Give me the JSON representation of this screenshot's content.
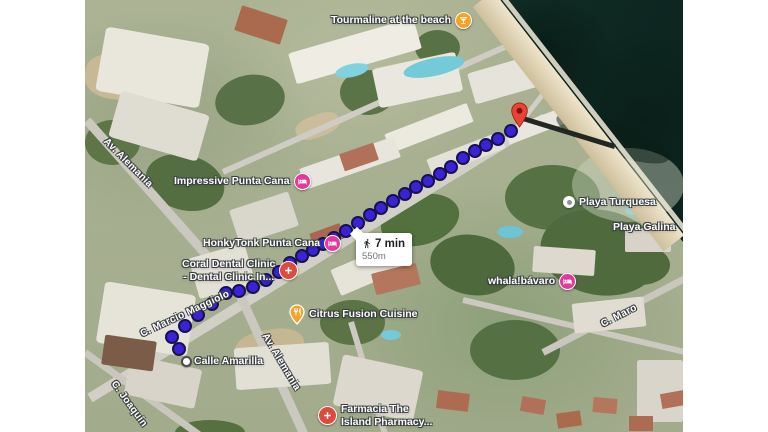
{
  "app": {
    "type": "map-satellite-view",
    "description": "Walking route on satellite map, Punta Cana"
  },
  "route_info": {
    "mode": "walking",
    "duration": "7 min",
    "distance": "550m"
  },
  "pois": {
    "tourmaline": {
      "label": "Tourmaline at the beach",
      "icon": "cocktail",
      "color": "#F4A326"
    },
    "impressive": {
      "label": "Impressive Punta Cana",
      "icon": "hotel-bed",
      "color": "#E4399B"
    },
    "honkytonk": {
      "label": "HonkyTonk Punta Cana",
      "icon": "hotel-bed",
      "color": "#E4399B"
    },
    "coral_dental": {
      "label_line1": "Coral Dental Clinic",
      "label_line2": "- Dental Clinic In...",
      "icon": "medical-cross",
      "color": "#DC4B3E"
    },
    "citrus": {
      "label": "Citrus Fusion Cuisine",
      "icon": "restaurant",
      "color": "#F4A326"
    },
    "whala": {
      "label": "whala!bávaro",
      "icon": "hotel-bed",
      "color": "#E4399B"
    },
    "playa_turquesa": {
      "label": "Playa Turquesa",
      "icon": "beach-dot"
    },
    "playa_galina": {
      "label": "Playa Galina"
    },
    "farmacia": {
      "label_line1": "Farmacia The",
      "label_line2": "Island Pharmacy...",
      "icon": "medical-cross",
      "color": "#DC4B3E"
    },
    "calle_amarilla": {
      "label": "Calle Amarilla"
    }
  },
  "streets": {
    "av_alemania_top": {
      "label": "Av. Alemania"
    },
    "av_alemania_bottom": {
      "label": "Av. Alemania"
    },
    "marcio_maggiolo": {
      "label": "C. Marcio Maggiolo"
    },
    "joaquin": {
      "label": "C. Joaquín"
    },
    "maro": {
      "label": "C. Maro"
    }
  },
  "route": {
    "start_point": [
      101,
      361
    ],
    "end_point": [
      434,
      127
    ],
    "dot_color": "#3A23D6",
    "dot_ring_color": "#191052",
    "path": [
      [
        94,
        349
      ],
      [
        87,
        337
      ],
      [
        100,
        326
      ],
      [
        113,
        315
      ],
      [
        127,
        304
      ],
      [
        141,
        293
      ],
      [
        154,
        291
      ],
      [
        168,
        287
      ],
      [
        181,
        280
      ],
      [
        194,
        272
      ],
      [
        205,
        263
      ],
      [
        217,
        256
      ],
      [
        228,
        250
      ],
      [
        238,
        244
      ],
      [
        249,
        238
      ],
      [
        261,
        231
      ],
      [
        273,
        223
      ],
      [
        285,
        215
      ],
      [
        296,
        208
      ],
      [
        308,
        201
      ],
      [
        320,
        194
      ],
      [
        331,
        187
      ],
      [
        343,
        181
      ],
      [
        355,
        174
      ],
      [
        366,
        167
      ],
      [
        378,
        158
      ],
      [
        390,
        151
      ],
      [
        401,
        145
      ],
      [
        413,
        139
      ],
      [
        426,
        131
      ]
    ]
  },
  "colors": {
    "water": "#13302A",
    "sand": "#D8CBAA",
    "destination_pin": "#EA4335",
    "poi_pink": "#E4399B",
    "poi_orange": "#F4A326",
    "poi_red": "#DC4B3E"
  }
}
